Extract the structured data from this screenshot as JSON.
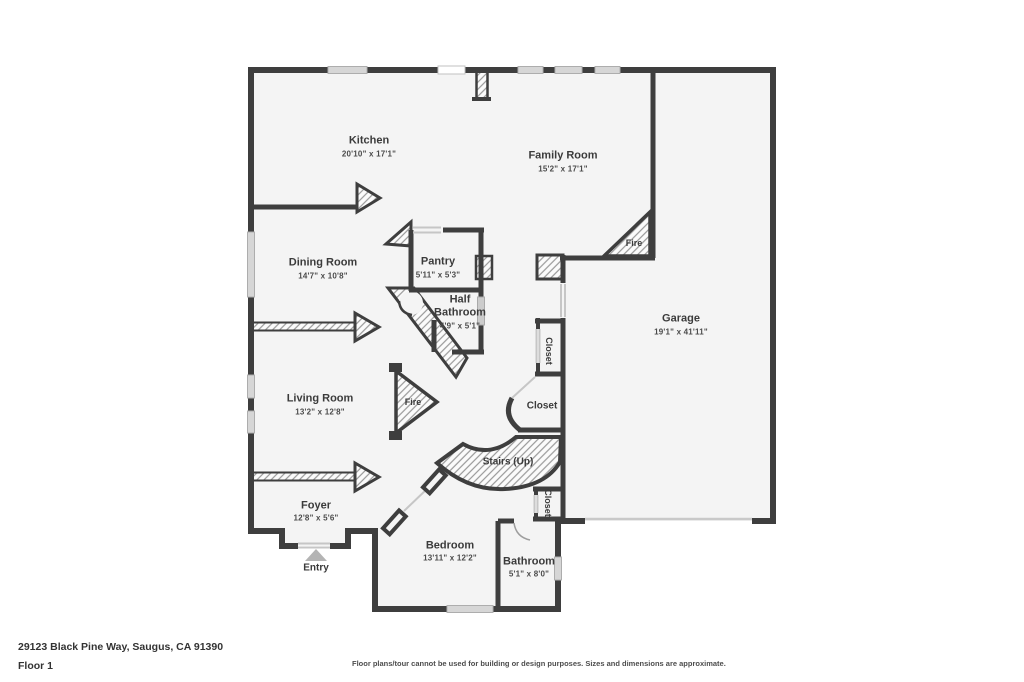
{
  "footer": {
    "address": "29123 Black Pine Way, Saugus, CA 91390",
    "floor": "Floor 1",
    "disclaimer": "Floor plans/tour cannot be used for building or design purposes. Sizes and dimensions are approximate."
  },
  "floorplan": {
    "rooms": [
      {
        "id": "kitchen",
        "name": "Kitchen",
        "dims": "20'10\" x 17'1\""
      },
      {
        "id": "family-room",
        "name": "Family Room",
        "dims": "15'2\" x 17'1\""
      },
      {
        "id": "dining-room",
        "name": "Dining Room",
        "dims": "14'7\" x 10'8\""
      },
      {
        "id": "pantry",
        "name": "Pantry",
        "dims": "5'11\" x 5'3\""
      },
      {
        "id": "half-bathroom",
        "name": "Half Bathroom",
        "dims": "4'9\" x 5'1\""
      },
      {
        "id": "garage",
        "name": "Garage",
        "dims": "19'1\" x 41'11\""
      },
      {
        "id": "living-room",
        "name": "Living Room",
        "dims": "13'2\" x 12'8\""
      },
      {
        "id": "foyer",
        "name": "Foyer",
        "dims": "12'8\" x 5'6\""
      },
      {
        "id": "bedroom",
        "name": "Bedroom",
        "dims": "13'11\" x 12'2\""
      },
      {
        "id": "bathroom",
        "name": "Bathroom",
        "dims": "5'1\" x 8'0\""
      }
    ],
    "features": {
      "fire": "Fire",
      "closet": "Closet",
      "stairs": "Stairs (Up)",
      "entry": "Entry"
    },
    "colors": {
      "wall": "#3e3e3e",
      "floor": "#f4f4f4",
      "window_fill": "#d6d6d6",
      "door_line": "#c6c6c6",
      "hatch_line": "#999999",
      "entry_marker": "#b4b4b4",
      "text": "#3b3b3b"
    }
  }
}
